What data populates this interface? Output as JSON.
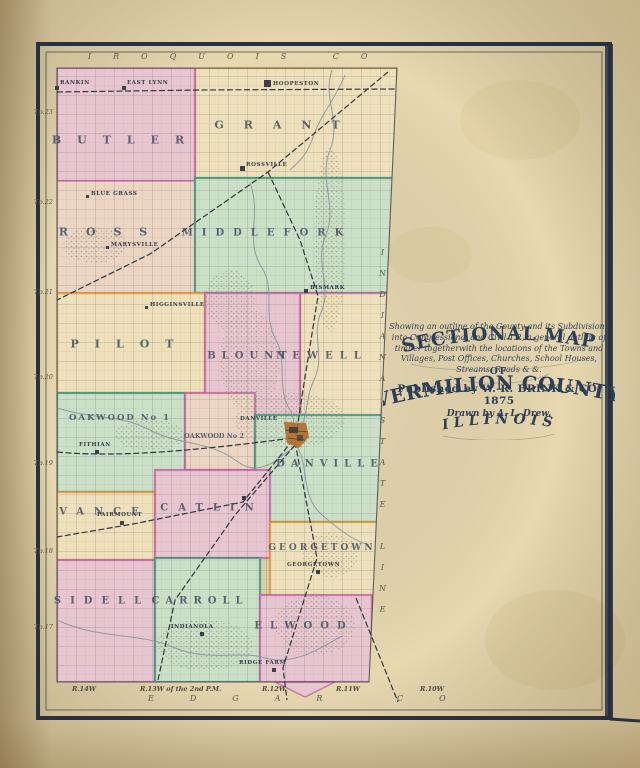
{
  "colors": {
    "paper": "#e7d8b0",
    "frame": "#27313f",
    "title_ink": "#2e3e57",
    "label_ink": "#4a5162",
    "pink": "#e8c6d0",
    "cream": "#ede0bb",
    "green": "#ccdfc7",
    "tan": "#ecd5c3",
    "magenta": "#c2619f",
    "orange": "#e0912e",
    "teal": "#35947c",
    "river": "#8a949b",
    "rail": "#30343c",
    "city": "#b06c2e"
  },
  "title_block": {
    "heading1": "SECTIONAL MAP",
    "heading2": "OF",
    "heading3": "VERMILION COUNTY",
    "heading4": "ILLINOIS",
    "description": "Showing an outline of the County and its Subdivisions into Congressional and Civil T.P., a general outline of timber togetherwith the locations of the Towns and Villages, Post Offices, Churches, School Houses, Streams, Roads & &.",
    "published": "Published by W. R. BRINK & CO. 1875",
    "drawn": "Drawn by A. L. Drew."
  },
  "map": {
    "edge_labels": {
      "top": "IROQUOIS CO",
      "bottom": "EDGAR CO",
      "right": "INDIANA STATE LINE",
      "township_rows": [
        "Tp.23",
        "Tp.22",
        "Tp.21",
        "Tp.20",
        "Tp.19",
        "Tp.18",
        "Tp.17"
      ],
      "ranges": [
        "R.14W",
        "R.13W of the 2nd P.M.",
        "R.12W",
        "R.11W",
        "R.10W"
      ]
    },
    "townships": [
      {
        "id": "butler",
        "label": "BUTLER"
      },
      {
        "id": "grant",
        "label": "GRANT"
      },
      {
        "id": "ross",
        "label": "ROSS"
      },
      {
        "id": "middlefork",
        "label": "MIDDLEFORK"
      },
      {
        "id": "pilot",
        "label": "PILOT"
      },
      {
        "id": "blount",
        "label": "BLOUNT"
      },
      {
        "id": "newell",
        "label": "NEWELL"
      },
      {
        "id": "oakwood1",
        "label": "OAKWOOD No 1"
      },
      {
        "id": "oakwood2",
        "label": "OAKWOOD No 2"
      },
      {
        "id": "danville",
        "label": "DANVILLE"
      },
      {
        "id": "vance",
        "label": "VANCE"
      },
      {
        "id": "catlin",
        "label": "CATLIN"
      },
      {
        "id": "georgetown",
        "label": "GEORGETOWN"
      },
      {
        "id": "sidell",
        "label": "SIDELL"
      },
      {
        "id": "carroll",
        "label": "CARROLL"
      },
      {
        "id": "elwood",
        "label": "ELWOOD"
      }
    ],
    "towns": [
      {
        "name": "RANKIN"
      },
      {
        "name": "EAST LYNN"
      },
      {
        "name": "HOOPESTON"
      },
      {
        "name": "ROSSVILLE"
      },
      {
        "name": "BLUE GRASS"
      },
      {
        "name": "MARYSVILLE"
      },
      {
        "name": "HIGGINSVILLE"
      },
      {
        "name": "BISMARK"
      },
      {
        "name": "FITHIAN"
      },
      {
        "name": "DANVILLE"
      },
      {
        "name": "FAIRMOUNT"
      },
      {
        "name": "GEORGETOWN"
      },
      {
        "name": "INDIANOLA"
      },
      {
        "name": "RIDGE FARM"
      }
    ]
  }
}
